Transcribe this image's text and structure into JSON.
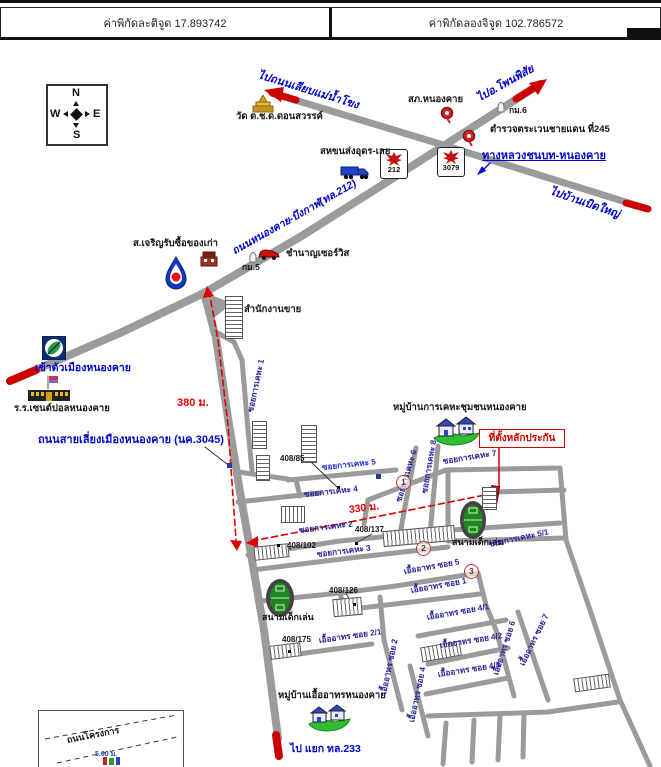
{
  "header": {
    "latitude": "ค่าพิกัดละติจูด 17.893742",
    "longitude": "ค่าพิกัดลองจิจูด 102.786572"
  },
  "compass": {
    "north": "N",
    "south": "S",
    "east": "E",
    "west": "W"
  },
  "highway_shields": {
    "shield_212": "212",
    "shield_3079": "3079"
  },
  "routes": {
    "to_river_road": "ไปถนนเลียบแม่น้ำโขง",
    "to_phonphisai": "ไปอ.โพนพิสัย",
    "to_ban_boed_yai": "ไปบ้านเบิดใหญ่",
    "nongkhai_bungkan_road": "ถนนหนองคาย-บึงกาฬ(ทล.212)",
    "rural_highway": "ทางหลวงชนบท-หนองคาย",
    "bypass_road": "ถนนสายเลี่ยงเมืองหนองคาย (นค.3045)",
    "to_city": "เข้าตัวเมืองหนองคาย",
    "to_junction_233": "ไป แยก ทล.233",
    "project_road": "ถนนโครงการ"
  },
  "places": {
    "temple": "วัด ต.ช.ด.ดอนสวรรค์",
    "police_station": "สภ.หนองคาย",
    "border_patrol": "ตำรวจตระเวนชายแดน ที่245",
    "transport_co": "สหขนส่งอุดร-เลย",
    "junk_shop": "ส.เจริญรับซื้อของเก่า",
    "chamnan_service": "ชำนาญเซอร์วิส",
    "sales_office": "สำนักงานขาย",
    "school": "ร.ร.เซนต์ปอลหนองคาย",
    "keha_village": "หมู่บ้านการเคหะชุมชนหนองคาย",
    "uea_athon_village": "หมู่บ้านเอื้ออาทรหนองคาย",
    "playground": "สนามเด็กเล่น",
    "collateral_site": "ที่ตั้งหลักประกัน"
  },
  "km_markers": {
    "km5": "กม.5",
    "km6": "กม.6"
  },
  "distances": {
    "d380": "380 ม.",
    "d330": "330 ม.",
    "d500": "5.00 ม."
  },
  "sois": {
    "keha1": "ซอยการเคหะ 1",
    "keha2": "ซอยการเคหะ 2",
    "keha3": "ซอยการเคหะ 3",
    "keha4": "ซอยการเคหะ 4",
    "keha5": "ซอยการเคหะ 5",
    "keha5_1": "ซอยการเคหะ 5/1",
    "keha6": "ซอยการเคหะ 6",
    "keha7": "ซอยการเคหะ 7",
    "keha8": "ซอยการเคหะ 8",
    "uea1": "เอื้ออาทร ซอย 1",
    "uea2": "เอื้ออาทร ซอย 2",
    "uea2_1": "เอื้ออาทร ซอย 2/1",
    "uea4": "เอื้ออาทร ซอย 4",
    "uea4_1": "เอื้ออาทร ซอย 4/1",
    "uea4_2": "เอื้ออาทร ซอย 4/2",
    "uea4_3": "เอื้ออาทร ซอย 4/3",
    "uea5": "เอื้ออาทร ซอย 5",
    "uea6": "เอื้ออาทร ซอย 6",
    "uea7": "เอื้ออาทร ซอย 7"
  },
  "house_numbers": {
    "n85": "408/85",
    "n102": "408/102",
    "n126": "408/126",
    "n137": "408/137",
    "n175": "408/175"
  },
  "spot_markers": {
    "m1": "1",
    "m2": "2",
    "m3": "3"
  },
  "colors": {
    "road": "#9b9b9b",
    "route_text": "#0008cc",
    "soi_text": "#262699",
    "distance_text": "#e60000",
    "collateral": "#cc0000"
  }
}
